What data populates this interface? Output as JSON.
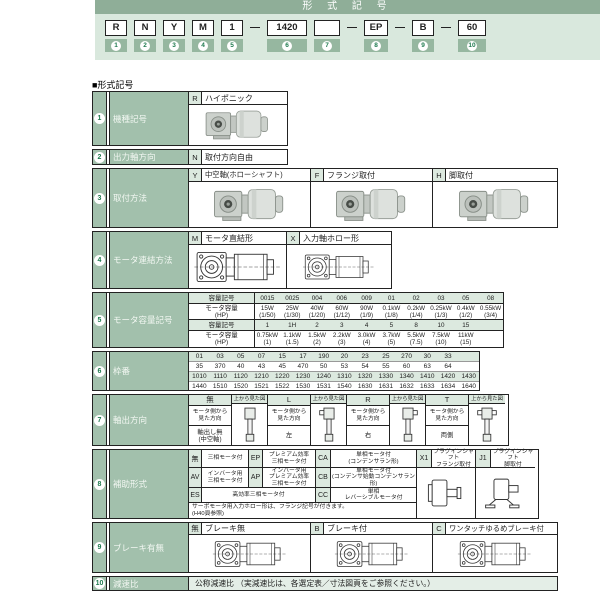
{
  "title_bar": "形 式 記 号",
  "section_label": "■形式記号",
  "code": {
    "dash": "—",
    "items": [
      {
        "label": "R",
        "num": "1"
      },
      {
        "label": "N",
        "num": "2"
      },
      {
        "label": "Y",
        "num": "3"
      },
      {
        "label": "M",
        "num": "4"
      },
      {
        "label": "1",
        "num": "5"
      },
      {
        "label": "1420",
        "num": "6"
      },
      {
        "label": "",
        "num": "7"
      },
      {
        "label": "EP",
        "num": "8"
      },
      {
        "label": "B",
        "num": "9"
      },
      {
        "label": "60",
        "num": "10"
      }
    ]
  },
  "rows": {
    "r1": {
      "num": "1",
      "label": "機種記号",
      "code": "R",
      "value": "ハイポニック"
    },
    "r2": {
      "num": "2",
      "label": "出力軸方向",
      "code": "N",
      "value": "取付方向自由"
    },
    "r3": {
      "num": "3",
      "label": "取付方法",
      "options": [
        {
          "code": "Y",
          "label": "中空軸(ホローシャフト)"
        },
        {
          "code": "F",
          "label": "フランジ取付"
        },
        {
          "code": "H",
          "label": "脚取付"
        }
      ]
    },
    "r4": {
      "num": "4",
      "label": "モータ連結方法",
      "options": [
        {
          "code": "M",
          "label": "モータ直結形"
        },
        {
          "code": "X",
          "label": "入力軸ホロー形"
        }
      ]
    },
    "r5": {
      "num": "5",
      "label": "モータ容量記号",
      "sym_header": "容量記号",
      "cap_header": "モータ容量\n(HP)",
      "t1_syms": [
        "0015",
        "0025",
        "004",
        "006",
        "009",
        "01",
        "02",
        "03",
        "05",
        "08"
      ],
      "t1_caps": [
        {
          "w": "15W",
          "hp": "(1/50)"
        },
        {
          "w": "25W",
          "hp": "(1/30)"
        },
        {
          "w": "40W",
          "hp": "(1/20)"
        },
        {
          "w": "60W",
          "hp": "(1/12)"
        },
        {
          "w": "90W",
          "hp": "(1/9)"
        },
        {
          "w": "0.1kW",
          "hp": "(1/8)"
        },
        {
          "w": "0.2kW",
          "hp": "(1/4)"
        },
        {
          "w": "0.25kW",
          "hp": "(1/3)"
        },
        {
          "w": "0.4kW",
          "hp": "(1/2)"
        },
        {
          "w": "0.55kW",
          "hp": "(3/4)"
        }
      ],
      "t2_syms": [
        "1",
        "1H",
        "2",
        "3",
        "4",
        "5",
        "8",
        "10",
        "15",
        ""
      ],
      "t2_caps": [
        {
          "w": "0.75kW",
          "hp": "(1)"
        },
        {
          "w": "1.1kW",
          "hp": "(1.5)"
        },
        {
          "w": "1.5kW",
          "hp": "(2)"
        },
        {
          "w": "2.2kW",
          "hp": "(3)"
        },
        {
          "w": "3.0kW",
          "hp": "(4)"
        },
        {
          "w": "3.7kW",
          "hp": "(5)"
        },
        {
          "w": "5.5kW",
          "hp": "(7.5)"
        },
        {
          "w": "7.5kW",
          "hp": "(10)"
        },
        {
          "w": "11kW",
          "hp": "(15)"
        },
        {
          "w": "",
          "hp": ""
        }
      ]
    },
    "r6": {
      "num": "6",
      "label": "枠番",
      "lines": [
        [
          "01",
          "03",
          "05",
          "07",
          "15",
          "17",
          "190",
          "20",
          "23",
          "25",
          "270",
          "30",
          "33",
          ""
        ],
        [
          "35",
          "370",
          "40",
          "43",
          "45",
          "470",
          "50",
          "53",
          "54",
          "55",
          "60",
          "63",
          "64",
          ""
        ],
        [
          "1010",
          "1110",
          "1120",
          "1210",
          "1220",
          "1230",
          "1240",
          "1310",
          "1320",
          "1330",
          "1340",
          "1410",
          "1420",
          "1430"
        ],
        [
          "1440",
          "1510",
          "1520",
          "1521",
          "1522",
          "1530",
          "1531",
          "1540",
          "1630",
          "1631",
          "1632",
          "1633",
          "1634",
          "1640"
        ]
      ]
    },
    "r7": {
      "num": "7",
      "label": "軸出方向",
      "view_label": "上から見た図",
      "dir_label": "モータ側から\n見た方向",
      "options": [
        {
          "code": "無",
          "dir": "軸出し無\n(中空軸)"
        },
        {
          "code": "L",
          "dir": "左"
        },
        {
          "code": "R",
          "dir": "右"
        },
        {
          "code": "T",
          "dir": "両側"
        }
      ]
    },
    "r8": {
      "num": "8",
      "label": "補助形式",
      "a1": {
        "code": "無",
        "label": "三相モータ付"
      },
      "a2": {
        "code": "EP",
        "label": "プレミアム効率\n三相モータ付"
      },
      "a3": {
        "code": "CA",
        "label": "単相モータ付\n(コンデンサラン形)"
      },
      "b1": {
        "code": "AV",
        "label": "インバータ用\n三相モータ付"
      },
      "b2": {
        "code": "AP",
        "label": "インバータ用\nプレミアム効率\n三相モータ付"
      },
      "b3": {
        "code": "CB",
        "label": "単相モータ付\n(コンデンサ始動コンデンサラン形)"
      },
      "c1": {
        "code": "ES",
        "label": "高効率三相モータ付"
      },
      "c2": {
        "code": "CC",
        "label": "単相\nレバーシブルモータ付"
      },
      "x1": {
        "code": "X1",
        "label": "プラグインシャフト\nフランジ取付"
      },
      "j1": {
        "code": "J1",
        "label": "プラグインシャフト\n脚取付"
      },
      "note": "サーボモータ用入力ホロー形は、フランジ記号が付きます。\n(H40頁参照)"
    },
    "r9": {
      "num": "9",
      "label": "ブレーキ有無",
      "options": [
        {
          "code": "無",
          "label": "ブレーキ無"
        },
        {
          "code": "B",
          "label": "ブレーキ付"
        },
        {
          "code": "C",
          "label": "ワンタッチゆるめブレーキ付"
        }
      ]
    },
    "r10": {
      "num": "10",
      "label": "減速比",
      "value": "公称減速比 （実減速比は、各選定表／寸法図頁をご参照ください。）"
    }
  },
  "colors": {
    "bar": "#8fae98",
    "panel": "#d9e8dd",
    "cell_green": "#a2c0ac",
    "cell_light": "#dce9df",
    "number_green": "#1e7a4e"
  }
}
